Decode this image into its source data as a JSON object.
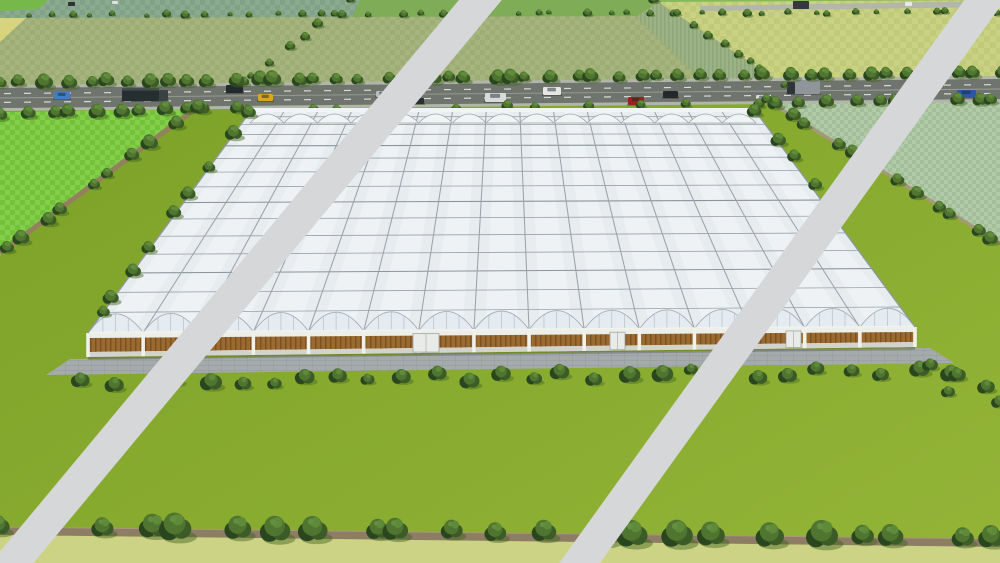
{
  "scene": {
    "description": "aerial-3d-render-of-large-greenhouse-complex-with-watermark-stripes",
    "canvas": {
      "w": 1000,
      "h": 563
    },
    "palette": {
      "lawn1": "#7aa026",
      "lawn2": "#93b437",
      "road": "#6f746e",
      "roadShoulder": "#b2b5a9",
      "laneDash": "#d9dad4",
      "laneLine": "#9a9e95",
      "distantRoad": "#b3b6aa",
      "stripe": "#d6d7d9",
      "dirtPath": "#8e7d65",
      "dirtPathEdge": "#a8977d",
      "bottomStrip": "#cdd384",
      "apron": "#a5aaac",
      "apronLine": "#8e9496",
      "roof": "#e7ecef",
      "roofLine": "#98a1a7",
      "roofLineDark": "#8c959c",
      "gutter": "#9aa3a9",
      "backBand": "#f1f4f5",
      "gableFill": "#e4ebf1",
      "gableStroke": "#a6afb6",
      "mullion": "#b6bfc6",
      "eave": "#f2f3ee",
      "wall": "#eceee8",
      "wallBase": "#d2d3cb",
      "brown1": "#9b6a31",
      "brown2": "#7b5122",
      "door": "#e9ebe9",
      "doorFrame": "#a0a6a6",
      "treeDark": "#2a461f",
      "tree1": "#3c5c27",
      "tree2": "#4f7530",
      "tree3": "#5f8a3a",
      "treeHi": "#648f3e",
      "treeShadow": "#41611c",
      "sage1": "#a6b57e",
      "sage2": "#9dad75",
      "bright1": "#83cf4a",
      "bright2": "#74c23b",
      "seafoam1": "#b1cba8",
      "seafoam2": "#a3bf9a",
      "yell1": "#c9d183",
      "yell2": "#c0ca79",
      "teal1": "#8aab8f",
      "teal2": "#81a286",
      "furrow1": "#9db386",
      "furrow2": "#8ea67a",
      "yellowWedge": "#d8d47e",
      "topMid": "#7fac57",
      "topRight": "#85b95c",
      "topLeftPatch": "#76b84a"
    },
    "fields": [
      {
        "name": "field-top-teal",
        "points": [
          [
            0,
            0
          ],
          [
            360,
            0
          ],
          [
            352,
            18
          ],
          [
            0,
            18
          ]
        ],
        "fill": "pat:teal"
      },
      {
        "name": "field-top-mid",
        "points": [
          [
            360,
            0
          ],
          [
            660,
            0
          ],
          [
            668,
            16
          ],
          [
            352,
            18
          ]
        ],
        "fill": "key:topMid"
      },
      {
        "name": "field-top-right",
        "points": [
          [
            660,
            0
          ],
          [
            1000,
            0
          ],
          [
            1000,
            14
          ],
          [
            668,
            16
          ]
        ],
        "fill": "key:topRight"
      },
      {
        "name": "field-topleft-patch",
        "points": [
          [
            0,
            0
          ],
          [
            48,
            0
          ],
          [
            38,
            9
          ],
          [
            0,
            11
          ]
        ],
        "fill": "key:topLeftPatch"
      },
      {
        "name": "field-sage",
        "points": [
          [
            0,
            18
          ],
          [
            668,
            16
          ],
          [
            784,
            84
          ],
          [
            237,
            88
          ],
          [
            0,
            92
          ]
        ],
        "fill": "pat:sage"
      },
      {
        "name": "field-yellow-wedge",
        "points": [
          [
            0,
            18
          ],
          [
            26,
            18
          ],
          [
            0,
            42
          ]
        ],
        "fill": "key:yellowWedge"
      },
      {
        "name": "field-furrow",
        "points": [
          [
            636,
            17
          ],
          [
            658,
            2
          ],
          [
            780,
            81
          ],
          [
            706,
            85
          ]
        ],
        "fill": "pat:furrow"
      },
      {
        "name": "field-yellowgreen",
        "points": [
          [
            658,
            2
          ],
          [
            1000,
            0
          ],
          [
            1000,
            76
          ],
          [
            782,
            83
          ]
        ],
        "fill": "pat:yell"
      },
      {
        "name": "field-bright-left",
        "points": [
          [
            0,
            112
          ],
          [
            196,
            109
          ],
          [
            0,
            256
          ]
        ],
        "fill": "pat:bright"
      },
      {
        "name": "field-seafoam-right",
        "points": [
          [
            768,
            101
          ],
          [
            1000,
            97
          ],
          [
            1000,
            244
          ]
        ],
        "fill": "pat:seafoam"
      }
    ],
    "distant_road": {
      "points": [
        [
          700,
          6
        ],
        [
          1000,
          1
        ],
        [
          1000,
          7
        ],
        [
          700,
          11
        ]
      ],
      "vehicles": [
        {
          "x": 793,
          "y": 1,
          "w": 16,
          "h": 8,
          "c": "#35393c"
        },
        {
          "x": 905,
          "y": 2,
          "w": 7,
          "h": 4,
          "c": "#e8e8e6"
        },
        {
          "x": 68,
          "y": 2,
          "w": 7,
          "h": 4,
          "c": "#2e3234"
        },
        {
          "x": 112,
          "y": 1,
          "w": 6,
          "h": 3,
          "c": "#dde0e0"
        }
      ]
    },
    "road": {
      "topY0": 88,
      "topY1": 79,
      "botY0": 108,
      "botY1": 99,
      "shoulder": 3,
      "dash": {
        "len": 7,
        "gap": 13,
        "width": 1.2
      }
    },
    "vehicles": [
      {
        "x": 54,
        "y": 92,
        "w": 16,
        "h": 7,
        "c": "#3f7fc4",
        "type": "car"
      },
      {
        "x": 122,
        "y": 88,
        "w": 46,
        "h": 13,
        "c": "#272e31",
        "type": "truck"
      },
      {
        "x": 226,
        "y": 85,
        "w": 17,
        "h": 8,
        "c": "#23282b",
        "type": "car"
      },
      {
        "x": 258,
        "y": 94,
        "w": 15,
        "h": 7,
        "c": "#d8a71f",
        "type": "car"
      },
      {
        "x": 376,
        "y": 91,
        "w": 13,
        "h": 6,
        "c": "#b9bdbf",
        "type": "car"
      },
      {
        "x": 412,
        "y": 98,
        "w": 12,
        "h": 6,
        "c": "#2b2f31",
        "type": "car"
      },
      {
        "x": 485,
        "y": 93,
        "w": 21,
        "h": 9,
        "c": "#d9dbdb",
        "type": "pickup"
      },
      {
        "x": 543,
        "y": 87,
        "w": 18,
        "h": 8,
        "c": "#e6e6e4",
        "type": "van"
      },
      {
        "x": 628,
        "y": 97,
        "w": 16,
        "h": 8,
        "c": "#9c2020",
        "type": "car"
      },
      {
        "x": 663,
        "y": 91,
        "w": 15,
        "h": 7,
        "c": "#26292b",
        "type": "car"
      },
      {
        "x": 756,
        "y": 95,
        "w": 13,
        "h": 6,
        "c": "#d9d9d7",
        "type": "car"
      },
      {
        "x": 787,
        "y": 77,
        "w": 33,
        "h": 17,
        "c": "#8f9598",
        "type": "bigtruck"
      },
      {
        "x": 957,
        "y": 90,
        "w": 19,
        "h": 7,
        "c": "#2a57a5",
        "type": "car"
      }
    ],
    "tree_rows": [
      {
        "name": "treerow-horizon",
        "from": [
          2,
          15
        ],
        "to": [
          998,
          12
        ],
        "count": 44,
        "rmin": 2.5,
        "rmax": 5,
        "seed": 11
      },
      {
        "name": "hedge-topleft",
        "from": [
          349,
          2
        ],
        "to": [
          238,
          86
        ],
        "count": 8,
        "rmin": 3.5,
        "rmax": 6,
        "seed": 21
      },
      {
        "name": "hedge-topright",
        "from": [
          658,
          2
        ],
        "to": [
          779,
          81
        ],
        "count": 9,
        "rmin": 3.5,
        "rmax": 6,
        "seed": 31
      },
      {
        "name": "treerow-road-north",
        "from": [
          2,
          82
        ],
        "to": [
          998,
          73
        ],
        "count": 48,
        "rmin": 6,
        "rmax": 9.5,
        "seed": 41
      },
      {
        "name": "treerow-road-south-left",
        "from": [
          2,
          114
        ],
        "to": [
          232,
          108
        ],
        "count": 11,
        "rmin": 6.5,
        "rmax": 9,
        "seed": 51
      },
      {
        "name": "treerow-road-south-right",
        "from": [
          778,
          103
        ],
        "to": [
          998,
          99
        ],
        "count": 10,
        "rmin": 5.5,
        "rmax": 8,
        "seed": 61
      },
      {
        "name": "verge-back-trees",
        "from": [
          255,
          109
        ],
        "to": [
          750,
          104
        ],
        "count": 11,
        "rmin": 4.5,
        "rmax": 6,
        "seed": 71
      },
      {
        "name": "hedge-left-road-trees",
        "from": [
          194,
          110
        ],
        "to": [
          2,
          252
        ],
        "count": 10,
        "rmin": 6,
        "rmax": 9,
        "seed": 81
      },
      {
        "name": "hedge-right-trees",
        "from": [
          770,
          102
        ],
        "to": [
          998,
          242
        ],
        "count": 12,
        "rmin": 5.5,
        "rmax": 8.5,
        "seed": 91
      },
      {
        "name": "greenhouse-west-trees",
        "from": [
          246,
          115
        ],
        "to": [
          98,
          318
        ],
        "count": 9,
        "rmin": 6.5,
        "rmax": 9,
        "seed": 101
      },
      {
        "name": "greenhouse-east-trees",
        "from": [
          758,
          114
        ],
        "to": [
          838,
          212
        ],
        "count": 5,
        "rmin": 6,
        "rmax": 8,
        "seed": 111
      },
      {
        "name": "bottom-hedge-trees",
        "from": [
          6,
          526
        ],
        "to": [
          996,
          538
        ],
        "count": 23,
        "rmin": 11,
        "rmax": 17,
        "seed": 121
      }
    ],
    "hedge_paths": [
      {
        "name": "left-dirt-road",
        "from": [
          195,
          109
        ],
        "to": [
          0,
          253
        ],
        "width": 5,
        "color": "#93815d"
      },
      {
        "name": "right-dirt-path",
        "from": [
          769,
          102
        ],
        "to": [
          1000,
          243
        ],
        "width": 3.5,
        "color": "#a39a79"
      }
    ],
    "bottom": {
      "path": [
        [
          0,
          527
        ],
        [
          1000,
          539
        ],
        [
          1000,
          547
        ],
        [
          0,
          535
        ]
      ],
      "strip": [
        [
          0,
          535
        ],
        [
          1000,
          547
        ],
        [
          1000,
          563
        ],
        [
          0,
          563
        ]
      ]
    },
    "greenhouse": {
      "bays": 15,
      "back": {
        "x0": 250,
        "x1": 756,
        "y": 112,
        "arcBase": 123,
        "arcCtl": 105,
        "bandTop": 108
      },
      "front": {
        "x0": 88,
        "x1": 915,
        "eaveY0": 333,
        "eaveY1": 327,
        "peakCtl": 38,
        "wallBotY0": 357,
        "wallBotY1": 347,
        "brownTopOff": 5,
        "brownBotOff": 5
      },
      "purlins": 14,
      "doors": [
        {
          "x": 188,
          "w": 15
        },
        {
          "x": 413,
          "w": 26
        },
        {
          "x": 610,
          "w": 15
        },
        {
          "x": 786,
          "w": 15
        }
      ],
      "apron": {
        "points": [
          [
            70,
            359
          ],
          [
            930,
            348
          ],
          [
            954,
            363
          ],
          [
            46,
            375
          ]
        ]
      }
    },
    "bushes_front": {
      "x0": 82,
      "x1": 948,
      "count": 28,
      "ybase": 385,
      "slope": -0.016,
      "jitter": 5,
      "rmin": 8,
      "rmax": 13,
      "seed": 131
    },
    "corner_bushes": [
      {
        "x": 930,
        "y": 365,
        "r": 9
      },
      {
        "x": 957,
        "y": 375,
        "r": 10
      },
      {
        "x": 986,
        "y": 387,
        "r": 10
      },
      {
        "x": 948,
        "y": 392,
        "r": 8
      },
      {
        "x": 999,
        "y": 402,
        "r": 9
      }
    ],
    "stripes": [
      {
        "name": "watermark-stripe-left",
        "x1": 497,
        "y1": -20,
        "x2": 2,
        "y2": 575,
        "width": 33
      },
      {
        "name": "watermark-stripe-right",
        "x1": 999,
        "y1": -20,
        "x2": 571,
        "y2": 575,
        "width": 33
      }
    ]
  }
}
